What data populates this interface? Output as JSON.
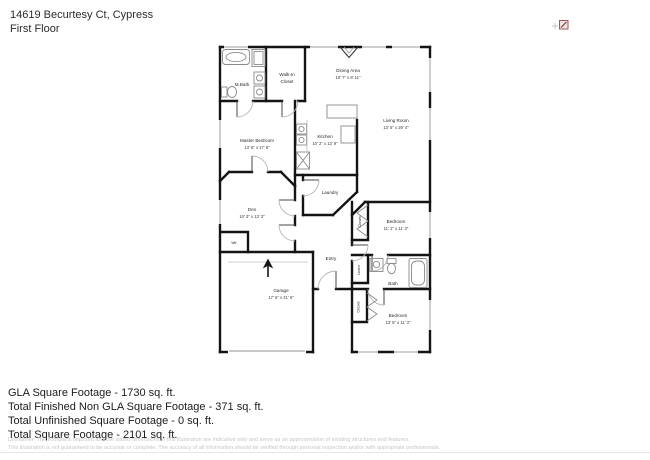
{
  "header": {
    "address": "14619 Becurtesy Ct, Cypress",
    "floor_label": "First Floor"
  },
  "floorplan": {
    "rooms": {
      "mbath": {
        "label": "M.Bath"
      },
      "walkin": {
        "line1": "Walk-In",
        "line2": "Closet"
      },
      "dining": {
        "label": "Dining Area",
        "dims": "10' 7\" x 8' 11\""
      },
      "living": {
        "label": "Living Room",
        "dims": "13' 5\" x 29' 4\""
      },
      "master": {
        "label": "Master Bedroom",
        "dims": "13' 8\" x 17' 8\""
      },
      "kitchen": {
        "label": "Kitchen",
        "dims": "10' 2\" x 13' 9\""
      },
      "laundry": {
        "label": "Laundry"
      },
      "den": {
        "label": "Den",
        "dims": "10' 3\" x 13' 3\""
      },
      "bedroom1": {
        "label": "Bedroom",
        "dims": "11' 1\" x 11' 3\""
      },
      "closet1": {
        "label": "Closet"
      },
      "entry": {
        "label": "Entry"
      },
      "linen": {
        "label": "Linen"
      },
      "bath": {
        "label": "Bath"
      },
      "closet2": {
        "label": "Closet"
      },
      "bedroom2": {
        "label": "Bedroom",
        "dims": "13' 5\" x 11' 3\""
      },
      "garage": {
        "label": "Garage",
        "dims": "17' 5\" x 21' 6\""
      },
      "wtr": {
        "label": "Wtr"
      }
    },
    "icons": {
      "north_arrow": "north-arrow-icon",
      "compass": "compass-icon"
    }
  },
  "summary": {
    "lines": [
      "GLA Square Footage - 1730 sq. ft.",
      "Total Finished Non GLA Square Footage - 371 sq. ft.",
      "Total Unfinished Square Footage - 0 sq. ft.",
      "Total Square Footage - 2101 sq. ft."
    ]
  },
  "disclaimer": {
    "line1": "Disclaimer: The floorplans depicted and the stated dimensions in this illustration are indicative only and serve as an approximation of existing structures and features.",
    "line2": "This illustration is not guaranteed to be accurate or complete. The accuracy of all information should be verified through personal inspection and/or with appropriate professionals."
  },
  "colors": {
    "wall": "#141414",
    "window_line": "#9e9e9e",
    "door_arc": "#b5b5b5",
    "text": "#2a2a2a",
    "disclaimer_text": "#c6c6c6",
    "compass_accent": "#8a4a4a"
  }
}
